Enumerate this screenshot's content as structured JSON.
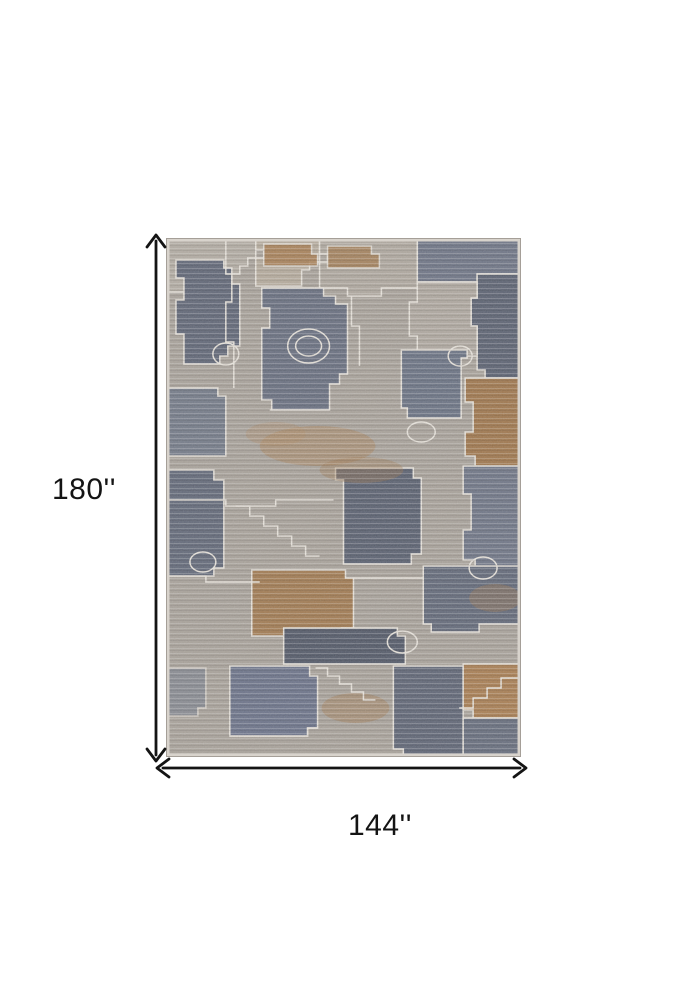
{
  "dimensions": {
    "height": "180''",
    "width": "144''"
  },
  "arrows": {
    "height_arrow": "vertical-double-headed-arrow",
    "width_arrow": "horizontal-double-headed-arrow"
  },
  "colors": {
    "background": "#ffffff",
    "arrow": "#141414",
    "label_text": "#141414",
    "rug_base_gray": "#a8a29b",
    "rug_slate_blue": "#626a7d",
    "rug_rust": "#a0774c",
    "rug_outline_cream": "#eae6df"
  }
}
